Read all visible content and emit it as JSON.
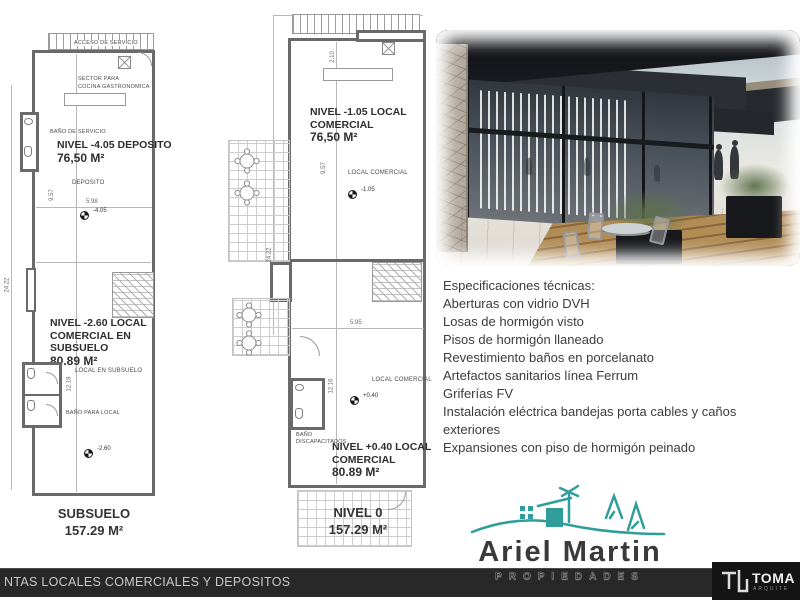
{
  "colors": {
    "accent_teal": "#2f9e9b",
    "footer_bar": "#282828",
    "brand_box": "#141414",
    "plan_wall": "#6a6a6a"
  },
  "plan_subsuelo": {
    "access_label": "ACCESO DE SERVICIO",
    "kitchen_l1": "SECTOR PARA",
    "kitchen_l2": "COCINA GASTRONOMICA",
    "service_bath": "BAÑO DE SERVICIO",
    "title1_l1": "NIVEL -4.05 DEPOSITO",
    "title1_l2": "76,50 M²",
    "room1": "DEPOSITO",
    "dim_v1": "9.57",
    "dim_w": "5.98",
    "level1": "-4.05",
    "dim_total": "24.22",
    "title2_l1": "NIVEL -2.60 LOCAL",
    "title2_l2": "COMERCIAL EN",
    "title2_l3": "SUBSUELO",
    "title2_l4": "80.89 M²",
    "room2": "LOCAL EN SUBSUELO",
    "dim_v2": "12.18",
    "bath2": "BAÑO PARA LOCAL",
    "level2": "-2.60",
    "caption": "SUBSUELO",
    "caption_area": "157.29 M²"
  },
  "plan_nivel0": {
    "dim_top": "2.10",
    "title1_l1": "NIVEL -1.05 LOCAL",
    "title1_l2": "COMERCIAL",
    "title1_l3": "76,50 M²",
    "room1": "LOCAL COMERCIAL",
    "level1": "-1.05",
    "dim_v1": "9.57",
    "dim_total": "24.22",
    "dim_w": "5.95",
    "room2": "LOCAL COMERCIAL",
    "level2": "+0.40",
    "dim_v2": "12.16",
    "bath_l1": "BAÑO",
    "bath_l2": "DISCAPACITADOS",
    "title2_l1": "NIVEL +0.40  LOCAL",
    "title2_l2": "COMERCIAL",
    "title2_l3": "80.89 M²",
    "caption": "NIVEL 0",
    "caption_area": "157.29 M²"
  },
  "specs": {
    "title": "Especificaciones técnicas:",
    "items": [
      "Aberturas con vidrio DVH",
      "Losas de hormigón visto",
      "Pisos de hormigón llaneado",
      "Revestimiento baños en porcelanato",
      "Artefactos sanitarios línea Ferrum",
      "Griferías FV",
      "Instalación eléctrica bandejas porta cables y caños exteriores",
      "Expansiones con piso de hormigón peinado"
    ]
  },
  "brand_logo": {
    "name": "Ariel Martin",
    "tagline": "PROPIEDADES"
  },
  "footer": {
    "title": "NTAS LOCALES COMERCIALES Y DEPOSITOS",
    "brand": "TOMA",
    "brand_sub": "ARQUITE"
  }
}
